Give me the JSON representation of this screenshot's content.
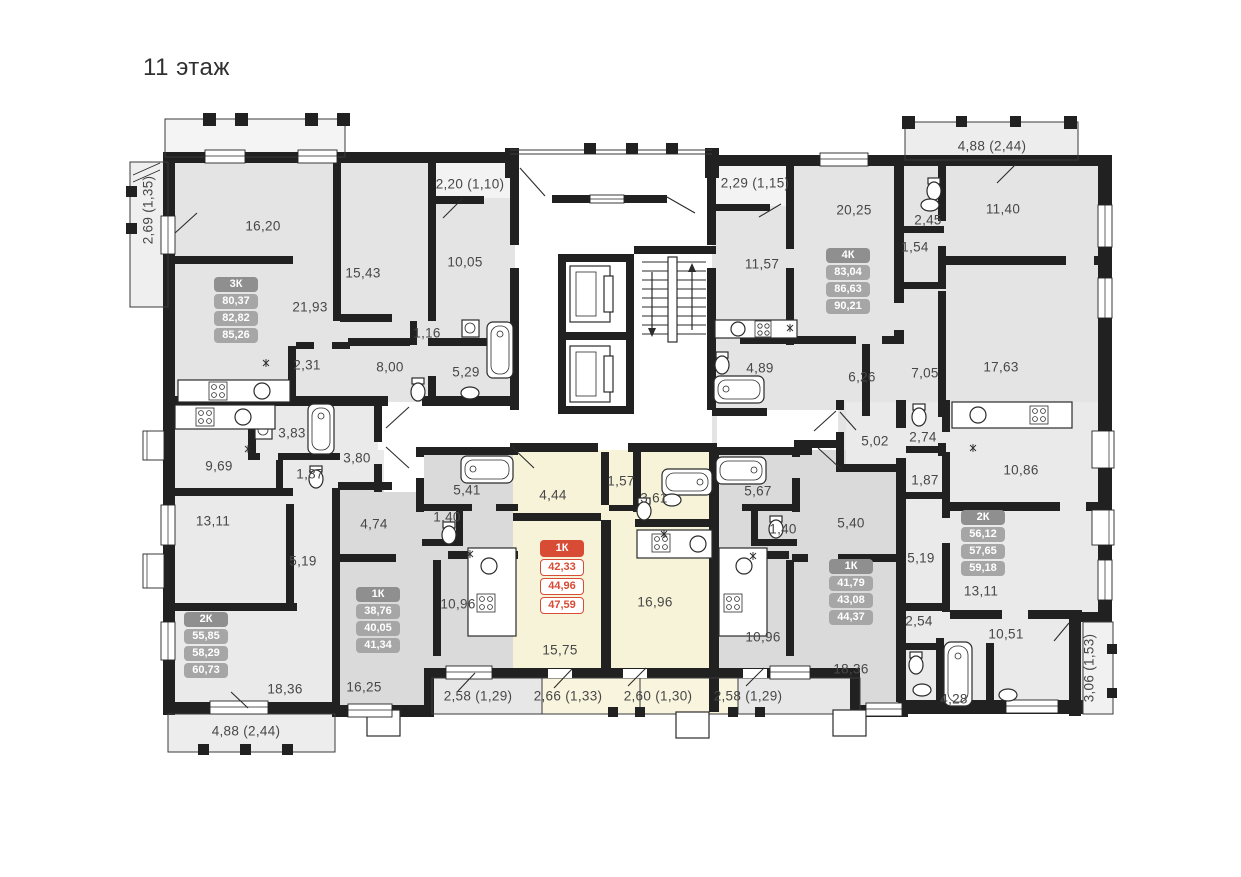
{
  "title": "11 этаж",
  "colors": {
    "wall": "#212121",
    "room_gray": "#e4e4e4",
    "room_gray_dark": "#dadada",
    "room_gray_light": "#eaeaea",
    "highlight_fill": "#f7f3d8",
    "highlight_balcony": "#f8f4dd",
    "accent": "#d84b35",
    "card_header": "#8f8f8f",
    "card_row": "#a6a6a6",
    "label_text": "#474747"
  },
  "apartments": [
    {
      "type": "3К",
      "values": [
        "80,37",
        "82,82",
        "85,26"
      ],
      "highlight": false,
      "x": 236,
      "y": 310
    },
    {
      "type": "4К",
      "values": [
        "83,04",
        "86,63",
        "90,21"
      ],
      "highlight": false,
      "x": 848,
      "y": 281
    },
    {
      "type": "2К",
      "values": [
        "55,85",
        "58,29",
        "60,73"
      ],
      "highlight": false,
      "x": 206,
      "y": 645
    },
    {
      "type": "1К",
      "values": [
        "38,76",
        "40,05",
        "41,34"
      ],
      "highlight": false,
      "x": 378,
      "y": 620
    },
    {
      "type": "1К",
      "values": [
        "42,33",
        "44,96",
        "47,59"
      ],
      "highlight": true,
      "x": 562,
      "y": 577
    },
    {
      "type": "1К",
      "values": [
        "41,79",
        "43,08",
        "44,37"
      ],
      "highlight": false,
      "x": 851,
      "y": 592
    },
    {
      "type": "2К",
      "values": [
        "56,12",
        "57,65",
        "59,18"
      ],
      "highlight": false,
      "x": 983,
      "y": 543
    }
  ],
  "room_labels": [
    {
      "text": "16,20",
      "x": 263,
      "y": 226
    },
    {
      "text": "15,43",
      "x": 363,
      "y": 273
    },
    {
      "text": "10,05",
      "x": 465,
      "y": 262
    },
    {
      "text": "2,20 (1,10)",
      "x": 470,
      "y": 184
    },
    {
      "text": "2,69 (1,35)",
      "x": 148,
      "y": 210,
      "v": true
    },
    {
      "text": "21,93",
      "x": 310,
      "y": 307
    },
    {
      "text": "1,16",
      "x": 427,
      "y": 333
    },
    {
      "text": "2,31",
      "x": 307,
      "y": 365
    },
    {
      "text": "8,00",
      "x": 390,
      "y": 367
    },
    {
      "text": "5,29",
      "x": 466,
      "y": 372
    },
    {
      "text": "2,29 (1,15)",
      "x": 755,
      "y": 183
    },
    {
      "text": "20,25",
      "x": 854,
      "y": 210
    },
    {
      "text": "2,45",
      "x": 928,
      "y": 220
    },
    {
      "text": "1,54",
      "x": 915,
      "y": 247
    },
    {
      "text": "11,40",
      "x": 1003,
      "y": 209
    },
    {
      "text": "4,88 (2,44)",
      "x": 992,
      "y": 146
    },
    {
      "text": "11,57",
      "x": 762,
      "y": 264
    },
    {
      "text": "4,89",
      "x": 760,
      "y": 368
    },
    {
      "text": "6,26",
      "x": 862,
      "y": 377
    },
    {
      "text": "7,05",
      "x": 925,
      "y": 373
    },
    {
      "text": "17,63",
      "x": 1001,
      "y": 367
    },
    {
      "text": "9,69",
      "x": 219,
      "y": 466
    },
    {
      "text": "3,83",
      "x": 292,
      "y": 433
    },
    {
      "text": "1,87",
      "x": 310,
      "y": 474
    },
    {
      "text": "3,80",
      "x": 357,
      "y": 458
    },
    {
      "text": "13,11",
      "x": 213,
      "y": 521
    },
    {
      "text": "5,19",
      "x": 303,
      "y": 561
    },
    {
      "text": "18,36",
      "x": 285,
      "y": 689
    },
    {
      "text": "4,88 (2,44)",
      "x": 246,
      "y": 731
    },
    {
      "text": "4,74",
      "x": 374,
      "y": 524
    },
    {
      "text": "5,41",
      "x": 467,
      "y": 490
    },
    {
      "text": "1,40",
      "x": 447,
      "y": 517
    },
    {
      "text": "10,96",
      "x": 458,
      "y": 604
    },
    {
      "text": "16,25",
      "x": 364,
      "y": 687
    },
    {
      "text": "2,58 (1,29)",
      "x": 478,
      "y": 696
    },
    {
      "text": "4,44",
      "x": 553,
      "y": 495
    },
    {
      "text": "1,57",
      "x": 621,
      "y": 481
    },
    {
      "text": "3,61",
      "x": 654,
      "y": 498
    },
    {
      "text": "15,75",
      "x": 560,
      "y": 650
    },
    {
      "text": "16,96",
      "x": 655,
      "y": 602
    },
    {
      "text": "2,66 (1,33)",
      "x": 568,
      "y": 696
    },
    {
      "text": "2,60 (1,30)",
      "x": 658,
      "y": 696
    },
    {
      "text": "5,67",
      "x": 758,
      "y": 491
    },
    {
      "text": "1,40",
      "x": 783,
      "y": 529
    },
    {
      "text": "5,40",
      "x": 851,
      "y": 523
    },
    {
      "text": "10,96",
      "x": 763,
      "y": 637
    },
    {
      "text": "18,36",
      "x": 851,
      "y": 669
    },
    {
      "text": "2,58 (1,29)",
      "x": 748,
      "y": 696
    },
    {
      "text": "5,02",
      "x": 875,
      "y": 441
    },
    {
      "text": "2,74",
      "x": 923,
      "y": 437
    },
    {
      "text": "1,87",
      "x": 925,
      "y": 480
    },
    {
      "text": "10,86",
      "x": 1021,
      "y": 470
    },
    {
      "text": "5,19",
      "x": 921,
      "y": 558
    },
    {
      "text": "13,11",
      "x": 981,
      "y": 591
    },
    {
      "text": "2,54",
      "x": 919,
      "y": 621
    },
    {
      "text": "10,51",
      "x": 1006,
      "y": 634
    },
    {
      "text": "4,28",
      "x": 954,
      "y": 699
    },
    {
      "text": "3,06 (1,53)",
      "x": 1089,
      "y": 668,
      "v": true
    }
  ]
}
